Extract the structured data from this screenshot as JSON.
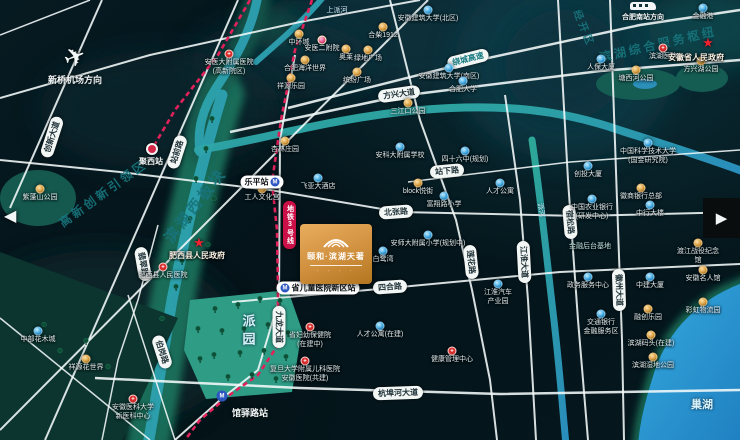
{
  "map": {
    "project": {
      "name": "颐和·滨湖天著"
    },
    "arrows": {
      "prev": "◀",
      "next": "▶"
    },
    "directions": {
      "airport": {
        "label": "新桥机场方向",
        "x": 75,
        "y": 42
      },
      "station": {
        "label": "合肥南站方向",
        "x": 643,
        "y": 2
      }
    },
    "regions": [
      {
        "t": "高新创新引领区",
        "x": 103,
        "y": 193,
        "r": -36,
        "s": 12
      },
      {
        "t": "滨湖西板块",
        "x": 195,
        "y": 205,
        "r": -52,
        "s": 15
      },
      {
        "t": "滨湖综合服务枢纽",
        "x": 658,
        "y": 44,
        "r": -13,
        "s": 12
      },
      {
        "t": "经开区",
        "x": 585,
        "y": 28,
        "r": 68,
        "s": 10
      }
    ],
    "water_labels": [
      {
        "t": "巢湖",
        "x": 702,
        "y": 404,
        "s": 11,
        "b": true
      },
      {
        "t": "上派河",
        "x": 337,
        "y": 10,
        "s": 7
      },
      {
        "t": "派河",
        "x": 541,
        "y": 210,
        "s": 7,
        "r": 80
      }
    ],
    "road_labels": [
      {
        "t": "创新大道",
        "x": 52,
        "y": 137,
        "r": -72
      },
      {
        "t": "站前路",
        "x": 177,
        "y": 152,
        "r": -72
      },
      {
        "t": "方兴大道",
        "x": 399,
        "y": 94,
        "r": -8
      },
      {
        "t": "绕城高速",
        "x": 468,
        "y": 59,
        "r": -14,
        "s": "hw"
      },
      {
        "t": "北张路",
        "x": 396,
        "y": 212,
        "r": -4
      },
      {
        "t": "站下路",
        "x": 447,
        "y": 171,
        "r": -5
      },
      {
        "t": "四合路",
        "x": 390,
        "y": 287,
        "r": -4
      },
      {
        "t": "杭埠河大道",
        "x": 398,
        "y": 393,
        "r": -2
      },
      {
        "t": "九龙大道",
        "x": 279,
        "y": 327,
        "r": 90
      },
      {
        "t": "莲花路",
        "x": 471,
        "y": 262,
        "r": 84
      },
      {
        "t": "江淮大道",
        "x": 524,
        "y": 262,
        "r": 87
      },
      {
        "t": "宿松路",
        "x": 570,
        "y": 222,
        "r": 85
      },
      {
        "t": "徽州大道",
        "x": 619,
        "y": 290,
        "r": 88
      },
      {
        "t": "翡翠路",
        "x": 143,
        "y": 264,
        "r": 80
      },
      {
        "t": "伯岗路",
        "x": 162,
        "y": 352,
        "r": 72
      }
    ],
    "metro": {
      "line_badge": "地铁3号线",
      "lines": [
        [
          [
            312,
            0
          ],
          [
            295,
            50
          ],
          [
            281,
            120
          ],
          [
            272,
            182
          ],
          [
            277,
            230
          ],
          [
            278,
            288
          ],
          [
            278,
            345
          ],
          [
            258,
            375
          ],
          [
            228,
            396
          ],
          [
            200,
            420
          ],
          [
            185,
            440
          ]
        ],
        [
          [
            250,
            0
          ],
          [
            218,
            55
          ],
          [
            175,
            110
          ],
          [
            152,
            149
          ]
        ]
      ],
      "stations": [
        {
          "n": "乐平站",
          "style": "pill",
          "icon": "right",
          "px": 262,
          "py": 182
        },
        {
          "n": "省儿童医院新区站",
          "style": "pill",
          "icon": "left",
          "px": 318,
          "py": 288
        },
        {
          "n": "馆驿路站",
          "style": "loose",
          "x": 222,
          "y": 396,
          "lx": 250,
          "ly": 406
        },
        {
          "n": "聚西站",
          "style": "dot",
          "x": 152,
          "y": 149,
          "lx": 151,
          "ly": 156
        }
      ]
    },
    "government": [
      {
        "n": "安徽省人民政府",
        "x": 708,
        "y": 43,
        "lx": 696,
        "ly": 52
      },
      {
        "n": "肥西县人民政府",
        "x": 199,
        "y": 243,
        "lx": 197,
        "ly": 250
      }
    ],
    "parks": [
      {
        "t": "派园",
        "x": 248,
        "y": 314,
        "vertical": true,
        "s": 13
      }
    ],
    "pois": [
      {
        "l": "安医大附属医院\n(高新院区)",
        "x": 229,
        "y": 54,
        "t": "r"
      },
      {
        "l": "中环城",
        "x": 299,
        "y": 34,
        "t": "g"
      },
      {
        "l": "安医二附院",
        "x": 322,
        "y": 40,
        "t": "p"
      },
      {
        "l": "奥莱",
        "x": 346,
        "y": 49,
        "t": "g"
      },
      {
        "l": "合柴1912",
        "x": 383,
        "y": 27,
        "t": "g"
      },
      {
        "l": "合肥海洋世界",
        "x": 305,
        "y": 60,
        "t": "g"
      },
      {
        "l": "祥源乐园",
        "x": 291,
        "y": 78,
        "t": "g"
      },
      {
        "l": "绿地广场",
        "x": 368,
        "y": 50,
        "t": "g"
      },
      {
        "l": "缤纷广场",
        "x": 357,
        "y": 72,
        "t": "g"
      },
      {
        "l": "安徽建筑大学(北区)",
        "x": 428,
        "y": 10,
        "t": "b"
      },
      {
        "l": "安徽建筑大学(南区)",
        "x": 449,
        "y": 68,
        "t": "b"
      },
      {
        "l": "合肥大学",
        "x": 463,
        "y": 81,
        "t": "b"
      },
      {
        "l": "三江口公园",
        "x": 408,
        "y": 103,
        "t": "g"
      },
      {
        "l": "滨湖医院",
        "x": 663,
        "y": 48,
        "t": "r"
      },
      {
        "l": "人保大厦",
        "x": 601,
        "y": 59,
        "t": "b"
      },
      {
        "l": "塘西河公园",
        "x": 636,
        "y": 70,
        "t": "g"
      },
      {
        "l": "方兴湖公园",
        "x": 701,
        "y": 61,
        "t": "g"
      },
      {
        "l": "金融港",
        "x": 703,
        "y": 8,
        "t": "b"
      },
      {
        "l": "杏林庄园",
        "x": 285,
        "y": 141,
        "t": "g"
      },
      {
        "l": "飞亚大酒店",
        "x": 318,
        "y": 178,
        "t": "b"
      },
      {
        "l": "工人文化宫",
        "x": 262,
        "y": 189,
        "t": "g"
      },
      {
        "l": "安科大附属学校",
        "x": 400,
        "y": 147,
        "t": "b"
      },
      {
        "l": "四十六中(规划)",
        "x": 465,
        "y": 151,
        "t": "b"
      },
      {
        "l": "block悦街",
        "x": 418,
        "y": 183,
        "t": "g"
      },
      {
        "l": "富翔路小学",
        "x": 444,
        "y": 196,
        "t": "b"
      },
      {
        "l": "人才公寓",
        "x": 500,
        "y": 183,
        "t": "b"
      },
      {
        "l": "安师大附属小学(规划中)",
        "x": 428,
        "y": 235,
        "t": "b"
      },
      {
        "l": "白鹭湾",
        "x": 383,
        "y": 251,
        "t": "b"
      },
      {
        "l": "江淮汽车\n产业园",
        "x": 498,
        "y": 284,
        "t": "b"
      },
      {
        "l": "省妇幼保健院\n(在建中)",
        "x": 310,
        "y": 327,
        "t": "r"
      },
      {
        "l": "复旦大学附属儿科医院\n安徽医院(共建)",
        "x": 305,
        "y": 361,
        "t": "r"
      },
      {
        "l": "健康管理中心",
        "x": 452,
        "y": 351,
        "t": "r"
      },
      {
        "l": "人才公寓(在建)",
        "x": 380,
        "y": 326,
        "t": "b"
      },
      {
        "l": "肥西县人民医院",
        "x": 163,
        "y": 267,
        "t": "r"
      },
      {
        "l": "中部花木城",
        "x": 38,
        "y": 331,
        "t": "b"
      },
      {
        "l": "祥源花世界",
        "x": 86,
        "y": 359,
        "t": "g"
      },
      {
        "l": "安徽医科大学\n新医科中心",
        "x": 133,
        "y": 399,
        "t": "r"
      },
      {
        "l": "交通银行\n金融服务区",
        "x": 601,
        "y": 314,
        "t": "b"
      },
      {
        "l": "融创乐园",
        "x": 648,
        "y": 309,
        "t": "g"
      },
      {
        "l": "滨湖码头(在建)",
        "x": 651,
        "y": 335,
        "t": "g"
      },
      {
        "l": "滨湖湿地公园",
        "x": 653,
        "y": 357,
        "t": "g"
      },
      {
        "l": "彩虹物流园",
        "x": 703,
        "y": 302,
        "t": "g"
      },
      {
        "l": "紫蓬山公园",
        "x": 40,
        "y": 189,
        "t": "g"
      },
      {
        "l": "创投大厦",
        "x": 588,
        "y": 166,
        "t": "b"
      },
      {
        "l": "中国农业银行\n(研发中心)",
        "x": 592,
        "y": 199,
        "t": "b"
      },
      {
        "l": "徽商银行总部",
        "x": 641,
        "y": 188,
        "t": "g"
      },
      {
        "l": "中行大楼",
        "x": 650,
        "y": 205,
        "t": "b"
      },
      {
        "l": "金融后台基地",
        "x": 590,
        "y": 247,
        "t": "x"
      },
      {
        "l": "政务服务中心",
        "x": 588,
        "y": 277,
        "t": "b"
      },
      {
        "l": "渡江战役纪念馆",
        "x": 698,
        "y": 243,
        "t": "g"
      },
      {
        "l": "安徽名人馆",
        "x": 703,
        "y": 270,
        "t": "g"
      },
      {
        "l": "中建大厦",
        "x": 650,
        "y": 277,
        "t": "b"
      },
      {
        "l": "中国科学技术大学\n(国金研究院)",
        "x": 648,
        "y": 143,
        "t": "b"
      }
    ],
    "colors": {
      "metro_line": "#e0215a",
      "gold": "#d9a75f",
      "blue": "#45b4e6",
      "red": "#d92f2e",
      "teal_text": "#18747c",
      "lake": "#2f9fd6",
      "logo_from": "#e8ad5e",
      "logo_to": "#b3751f"
    }
  },
  "geometry": {
    "blobs": [
      [
        420,
        30,
        160,
        60,
        "#0b313c",
        0.8
      ],
      [
        565,
        65,
        110,
        95,
        "#0d3d48",
        0.7
      ],
      [
        565,
        65,
        60,
        55,
        "#0a313c",
        0.8
      ],
      [
        100,
        340,
        140,
        90,
        "#07262b",
        0.9
      ],
      [
        710,
        28,
        62,
        42,
        "#0e4a50",
        0.8
      ],
      [
        280,
        60,
        90,
        40,
        "#0a2f38",
        0.7
      ],
      [
        272,
        26,
        26,
        14,
        "#175a4e",
        0.9
      ],
      [
        160,
        110,
        120,
        60,
        "#0a2b31",
        0.6
      ]
    ],
    "greens": [
      {
        "d": "M222,95 C202,160 186,230 172,300 C162,360 156,400 148,445",
        "stroke": "#1e7a62",
        "w": 44,
        "o": 0.85
      },
      {
        "d": "M258,-5 C252,30 236,58 216,88 C202,110 197,130 200,152",
        "stroke": "#175a4e",
        "w": 26,
        "o": 0.8
      },
      {
        "d": "M745,282 C700,298 669,329 655,370 C646,398 640,420 638,445",
        "stroke": "#1f7a5e",
        "w": 10,
        "o": 0.9
      }
    ],
    "lake": {
      "d": "M745,282 C700,298 669,329 655,370 C646,398 640,420 638,445 L745,445 Z"
    },
    "rivers": [
      {
        "d": "M258,-5 C252,30 236,58 216,88 C202,110 197,130 200,152",
        "w": 9
      },
      {
        "d": "M325,-5 C303,22 276,44 256,62",
        "w": 6
      },
      {
        "d": "M222,95 C202,160 186,230 172,300 C162,360 156,400 148,445",
        "w": 11
      },
      {
        "d": "M198,150 C262,140 330,118 420,110 C505,103 562,110 622,131 C676,148 712,160 745,172",
        "w": 8
      },
      {
        "d": "M532,140 C541,200 546,252 553,312 C559,362 562,402 566,445",
        "w": 7
      }
    ],
    "parks": [
      {
        "d": "M190,300 L288,290 L302,330 L292,392 L206,399 L184,350 Z",
        "f": "#2f9c86"
      },
      {
        "e": [
          38,
          198,
          38,
          28
        ],
        "f": "#14584e"
      },
      {
        "d": "M0,252 L178,318 L120,445 L0,445 Z",
        "f": "#0c3530"
      },
      {
        "e": [
          638,
          84,
          42,
          16
        ],
        "f": "#155c52"
      },
      {
        "e": [
          702,
          78,
          26,
          14
        ],
        "f": "#155c52"
      },
      {
        "e": [
          645,
          84,
          12,
          5
        ],
        "f": "#2b8fb8"
      }
    ],
    "roads": [
      {
        "p": [
          [
            10,
            208
          ],
          [
            102,
            0
          ]
        ],
        "w": 2
      },
      {
        "p": [
          [
            45,
            440
          ],
          [
            238,
            0
          ]
        ],
        "w": 2
      },
      {
        "p": [
          [
            0,
            430
          ],
          [
            428,
            0
          ]
        ],
        "w": 2
      },
      {
        "p": [
          [
            0,
            160
          ],
          [
            120,
            172
          ],
          [
            270,
            190
          ],
          [
            400,
            212
          ],
          [
            580,
            216
          ],
          [
            740,
            212
          ]
        ],
        "w": 2
      },
      {
        "p": [
          [
            230,
            132
          ],
          [
            400,
            96
          ],
          [
            600,
            71
          ],
          [
            740,
            60
          ]
        ],
        "w": 2.5
      },
      {
        "p": [
          [
            288,
            108
          ],
          [
            470,
            62
          ],
          [
            640,
            25
          ],
          [
            740,
            10
          ]
        ],
        "w": 2.5
      },
      {
        "p": [
          [
            232,
            302
          ],
          [
            390,
            288
          ],
          [
            560,
            272
          ],
          [
            740,
            264
          ]
        ],
        "w": 2
      },
      {
        "p": [
          [
            95,
            378
          ],
          [
            300,
            388
          ],
          [
            500,
            394
          ],
          [
            740,
            390
          ]
        ],
        "w": 2.5
      },
      {
        "p": [
          [
            295,
            55
          ],
          [
            280,
            140
          ],
          [
            279,
            300
          ],
          [
            258,
            370
          ],
          [
            220,
            400
          ],
          [
            175,
            440
          ]
        ],
        "w": 2
      },
      {
        "p": [
          [
            390,
            0
          ],
          [
            420,
            120
          ],
          [
            456,
            220
          ],
          [
            472,
            290
          ],
          [
            490,
            380
          ],
          [
            497,
            440
          ]
        ],
        "w": 2
      },
      {
        "p": [
          [
            505,
            95
          ],
          [
            520,
            200
          ],
          [
            528,
            300
          ],
          [
            536,
            440
          ]
        ],
        "w": 2
      },
      {
        "p": [
          [
            558,
            0
          ],
          [
            568,
            180
          ],
          [
            578,
            320
          ],
          [
            588,
            440
          ]
        ],
        "w": 2
      },
      {
        "p": [
          [
            610,
            0
          ],
          [
            617,
            200
          ],
          [
            622,
            340
          ],
          [
            624,
            440
          ]
        ],
        "w": 2
      },
      {
        "p": [
          [
            158,
            225
          ],
          [
            138,
            300
          ],
          [
            118,
            360
          ],
          [
            102,
            440
          ]
        ],
        "w": 1.5
      },
      {
        "p": [
          [
            128,
            295
          ],
          [
            175,
            440
          ]
        ],
        "w": 1.5
      },
      {
        "p": [
          [
            408,
            182
          ],
          [
            570,
            162
          ],
          [
            740,
            150
          ]
        ],
        "w": 1.5
      },
      {
        "p": [
          [
            0,
            98
          ],
          [
            150,
            55
          ],
          [
            300,
            22
          ],
          [
            420,
            0
          ]
        ],
        "w": 2
      },
      {
        "p": [
          [
            0,
            35
          ],
          [
            90,
            0
          ]
        ],
        "w": 1.5
      },
      {
        "p": [
          [
            0,
            318
          ],
          [
            150,
            440
          ]
        ],
        "w": 1.5
      }
    ],
    "trees": [
      [
        215,
        310
      ],
      [
        238,
        306
      ],
      [
        260,
        300
      ],
      [
        280,
        302
      ],
      [
        222,
        332
      ],
      [
        244,
        330
      ],
      [
        268,
        326
      ],
      [
        288,
        334
      ],
      [
        214,
        356
      ],
      [
        240,
        354
      ],
      [
        264,
        352
      ],
      [
        286,
        358
      ],
      [
        228,
        378
      ],
      [
        252,
        376
      ],
      [
        276,
        380
      ],
      [
        198,
        330
      ],
      [
        200,
        360
      ],
      [
        212,
        120
      ],
      [
        206,
        150
      ],
      [
        196,
        180
      ],
      [
        214,
        200
      ],
      [
        190,
        220
      ],
      [
        208,
        246
      ],
      [
        182,
        262
      ],
      [
        176,
        288
      ],
      [
        162,
        320
      ],
      [
        158,
        346
      ],
      [
        86,
        342
      ],
      [
        60,
        352
      ],
      [
        108,
        368
      ],
      [
        44,
        326
      ]
    ]
  }
}
